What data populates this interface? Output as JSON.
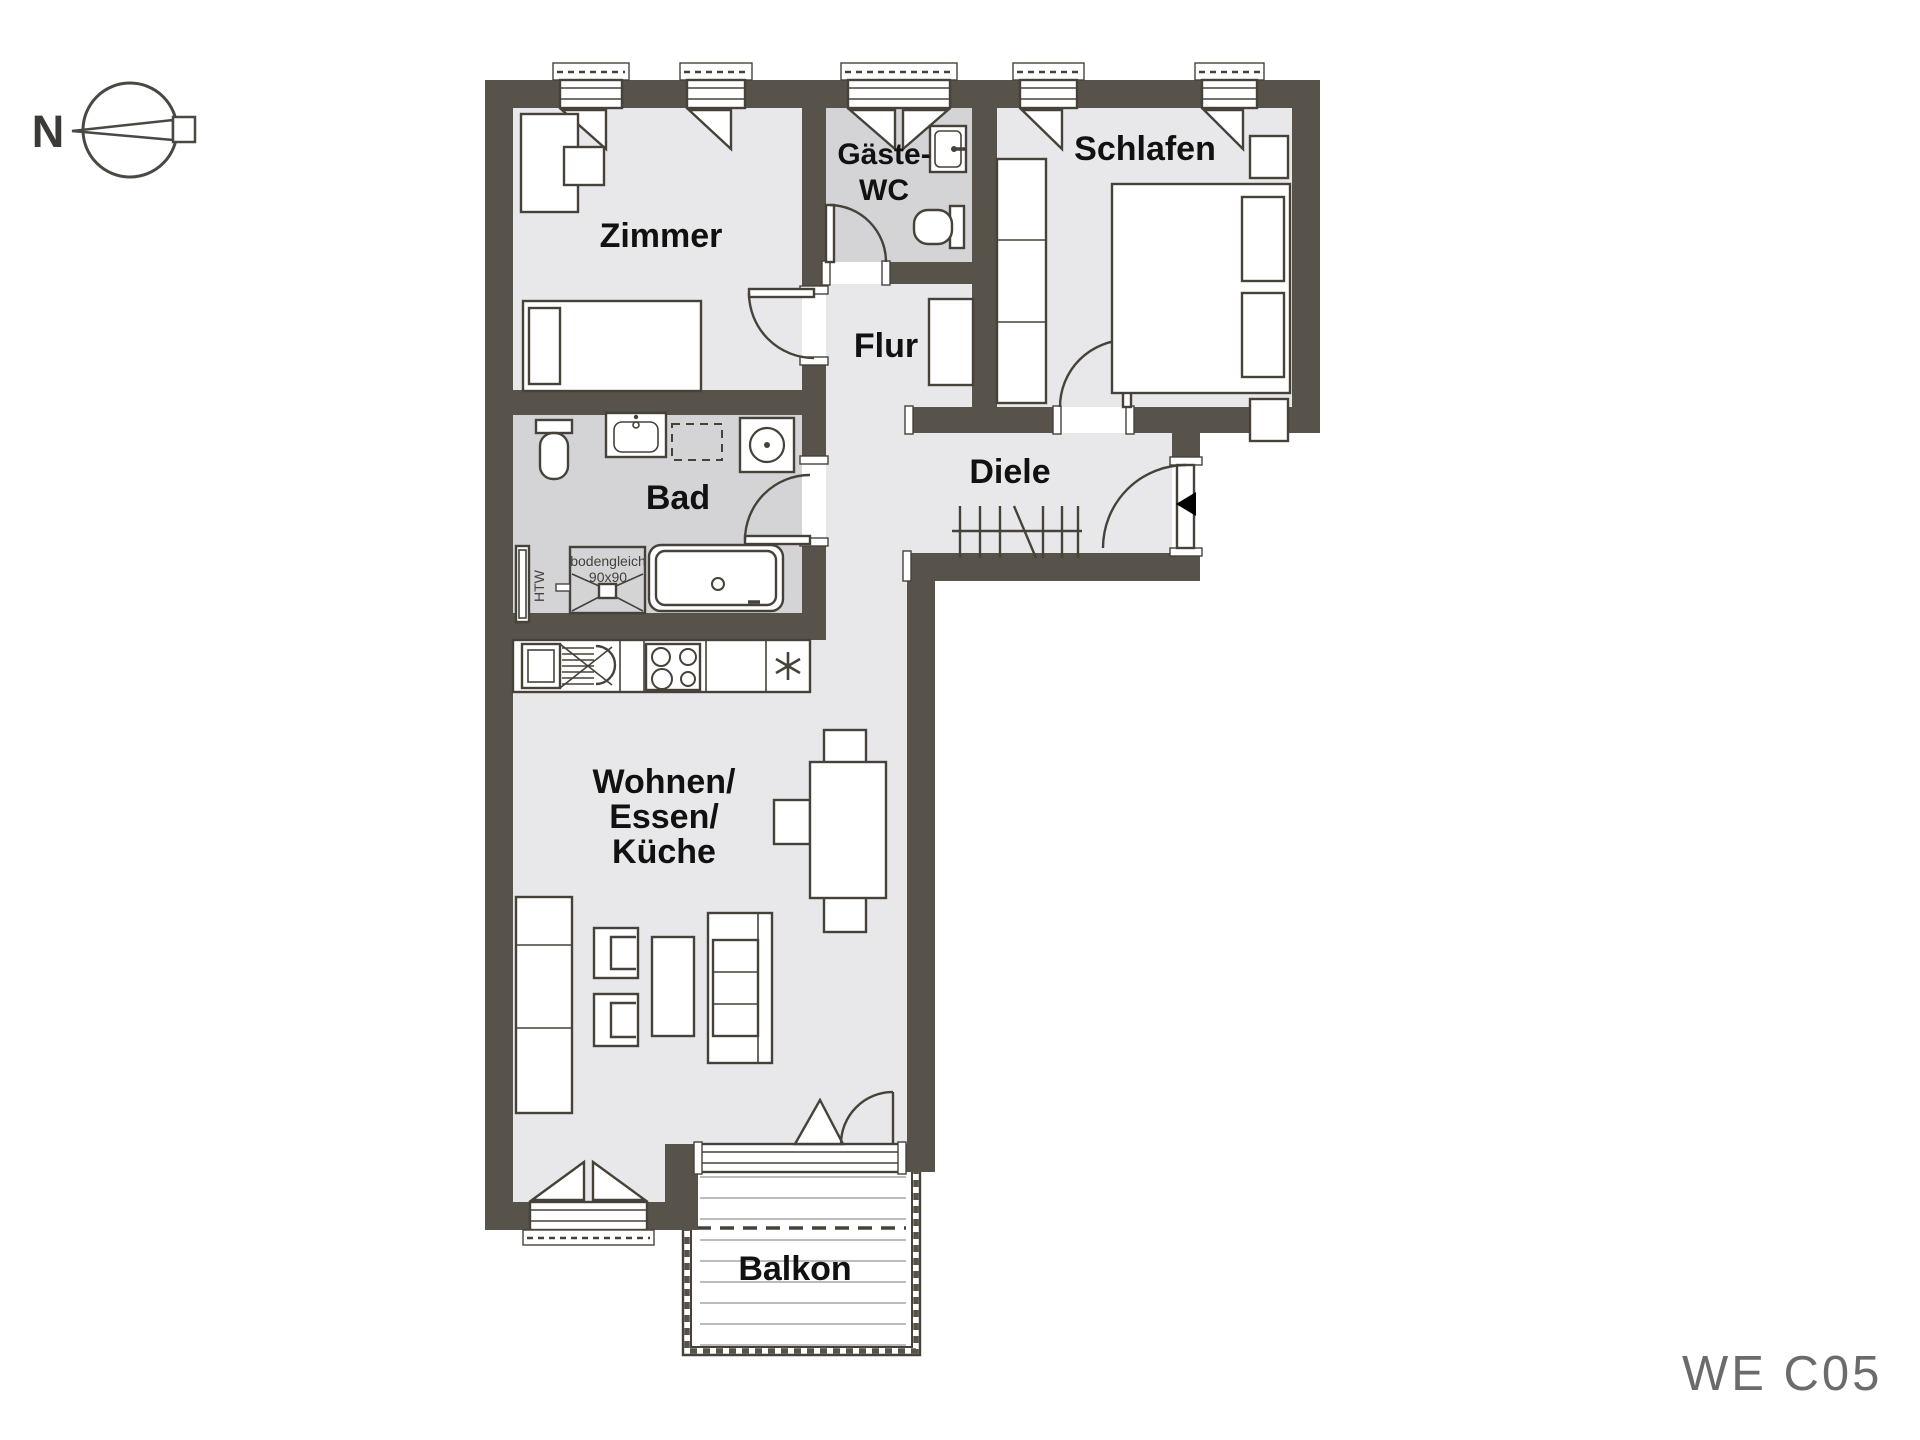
{
  "palette": {
    "wall": "#57524a",
    "floor_light": "#e8e8ea",
    "floor_wet": "#d4d4d6",
    "line": "#46423a",
    "plank": "#bcbcbc",
    "text": "#111111",
    "muted_text": "#6b6b6b",
    "bg": "#ffffff"
  },
  "compass": {
    "north_label": "N"
  },
  "rooms": {
    "zimmer": "Zimmer",
    "gaeste_wc_line1": "Gäste-",
    "gaeste_wc_line2": "WC",
    "schlafen": "Schlafen",
    "flur": "Flur",
    "diele": "Diele",
    "bad": "Bad",
    "wohnen_line1": "Wohnen/",
    "wohnen_line2": "Essen/",
    "wohnen_line3": "Küche",
    "balkon": "Balkon"
  },
  "annotations": {
    "shower_line1": "bodengleich",
    "shower_line2": "90x90",
    "towel_radiator": "HTW"
  },
  "unit_label": "WE C05"
}
